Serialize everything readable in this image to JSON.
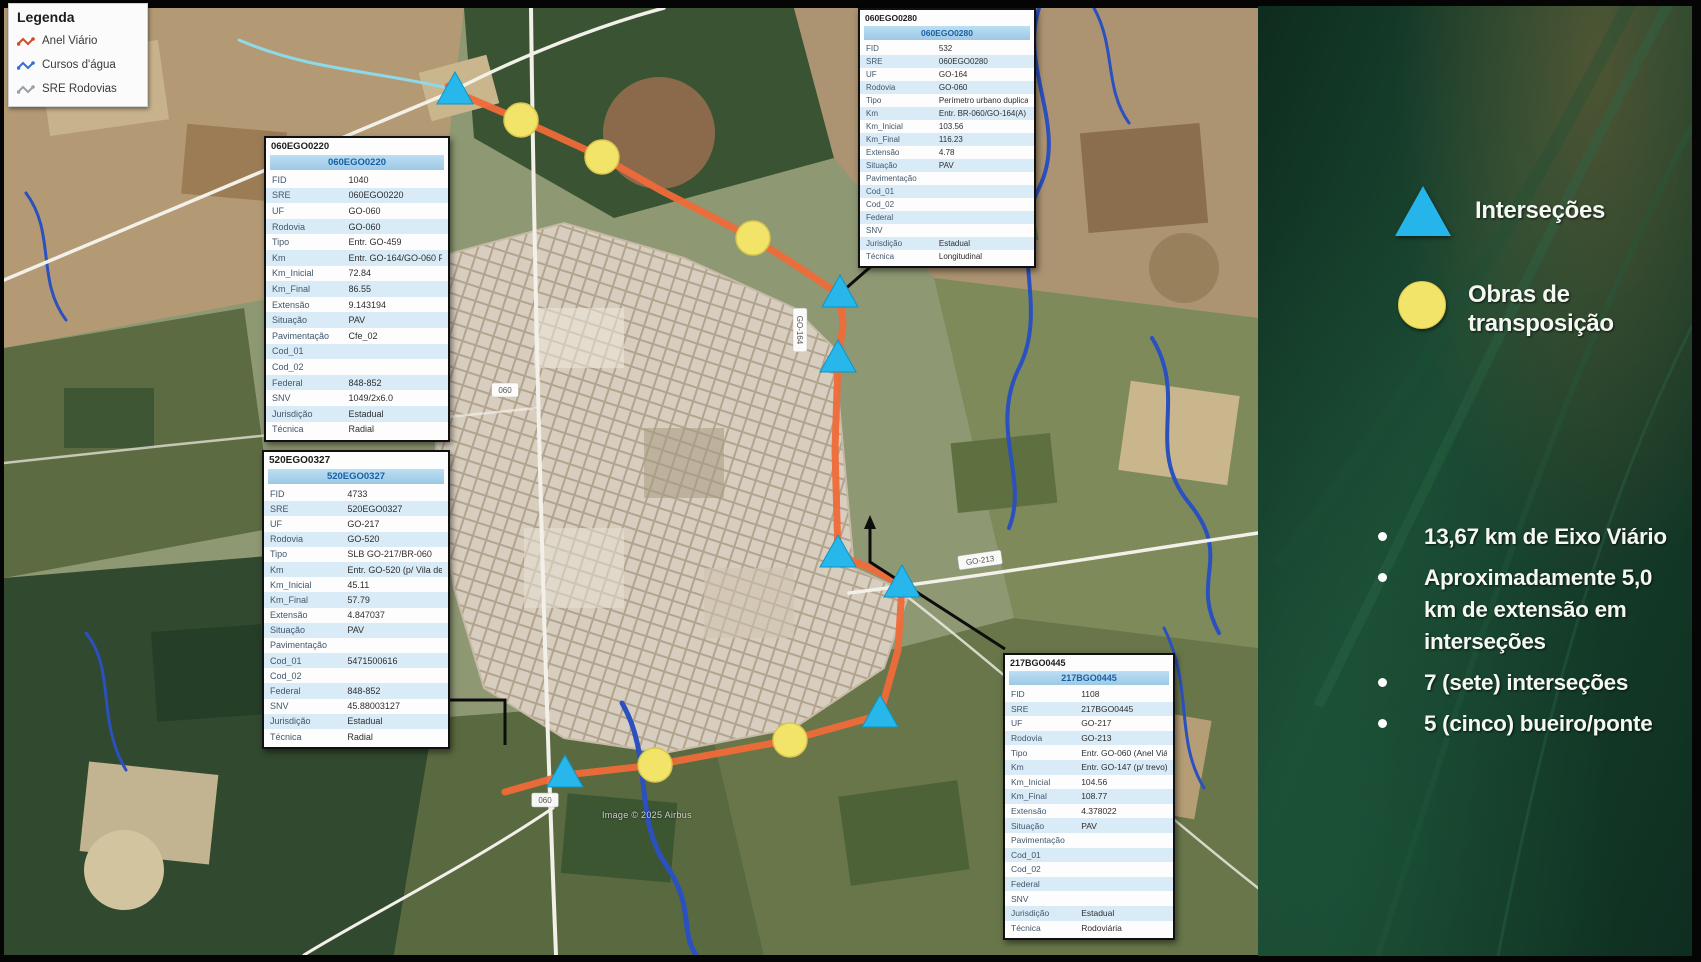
{
  "colors": {
    "route": "#f06a38",
    "intersection": "#27b7ea",
    "intersection_edge": "#0e94c6",
    "transposition": "#f2e468",
    "transposition_edge": "#d8c64e",
    "panel_header_bg": "#a9d2ec",
    "sidebar_green": "#1b4a33"
  },
  "legend_box": {
    "title": "Legenda",
    "items": [
      {
        "label": "Anel Viário",
        "color": "#d24a28",
        "icon": "route-line-icon"
      },
      {
        "label": "Cursos d'água",
        "color": "#3a6bd8",
        "icon": "water-line-icon"
      },
      {
        "label": "SRE Rodovias",
        "color": "#9aa0a8",
        "icon": "road-line-icon"
      }
    ]
  },
  "sidebar": {
    "legend_intersections": "Interseções",
    "legend_transpositions": "Obras de transposição",
    "bullets": [
      "13,67 km de Eixo Viário",
      "Aproximadamente 5,0 km de extensão em interseções",
      "7 (sete) interseções",
      "5 (cinco) bueiro/ponte"
    ]
  },
  "panels": [
    {
      "title": "060EGO0220",
      "header": "060EGO0220",
      "rows": [
        [
          "FID",
          "1040"
        ],
        [
          "SRE",
          "060EGO0220"
        ],
        [
          "UF",
          "GO-060"
        ],
        [
          "Rodovia",
          "GO-060"
        ],
        [
          "Tipo",
          "Entr. GO-459"
        ],
        [
          "Km",
          "Entr. GO-164/GO-060 Per. de Goiás"
        ],
        [
          "Km_Inicial",
          "72.84"
        ],
        [
          "Km_Final",
          "86.55"
        ],
        [
          "Extensão",
          "9.143194"
        ],
        [
          "Situação",
          "PAV"
        ],
        [
          "Pavimentação",
          "Cfe_02"
        ],
        [
          "Cod_01",
          ""
        ],
        [
          "Cod_02",
          ""
        ],
        [
          "Federal",
          "848-852"
        ],
        [
          "SNV",
          "1049/2x6.0"
        ],
        [
          "Jurisdição",
          "Estadual"
        ],
        [
          "Técnica",
          "Radial"
        ]
      ]
    },
    {
      "title": "520EGO0327",
      "header": "520EGO0327",
      "rows": [
        [
          "FID",
          "4733"
        ],
        [
          "SRE",
          "520EGO0327"
        ],
        [
          "UF",
          "GO-217"
        ],
        [
          "Rodovia",
          "GO-520"
        ],
        [
          "Tipo",
          "SLB GO-217/BR-060"
        ],
        [
          "Km",
          "Entr. GO-520 (p/ Vila de Goiás)"
        ],
        [
          "Km_Inicial",
          "45.11"
        ],
        [
          "Km_Final",
          "57.79"
        ],
        [
          "Extensão",
          "4.847037"
        ],
        [
          "Situação",
          "PAV"
        ],
        [
          "Pavimentação",
          ""
        ],
        [
          "Cod_01",
          "5471500616"
        ],
        [
          "Cod_02",
          ""
        ],
        [
          "Federal",
          "848-852"
        ],
        [
          "SNV",
          "45.88003127"
        ],
        [
          "Jurisdição",
          "Estadual"
        ],
        [
          "Técnica",
          "Radial"
        ]
      ]
    },
    {
      "title": "060EGO0280",
      "header": "060EGO0280",
      "rows": [
        [
          "FID",
          "532"
        ],
        [
          "SRE",
          "060EGO0280"
        ],
        [
          "UF",
          "GO-164"
        ],
        [
          "Rodovia",
          "GO-060"
        ],
        [
          "Tipo",
          "Perímetro urbano duplicado"
        ],
        [
          "Km",
          "Entr. BR-060/GO-164(A)"
        ],
        [
          "Km_Inicial",
          "103.56"
        ],
        [
          "Km_Final",
          "116.23"
        ],
        [
          "Extensão",
          "4.78"
        ],
        [
          "Situação",
          "PAV"
        ],
        [
          "Pavimentação",
          ""
        ],
        [
          "Cod_01",
          ""
        ],
        [
          "Cod_02",
          ""
        ],
        [
          "Federal",
          ""
        ],
        [
          "SNV",
          ""
        ],
        [
          "Jurisdição",
          "Estadual"
        ],
        [
          "Técnica",
          "Longitudinal"
        ]
      ]
    },
    {
      "title": "217BGO0445",
      "header": "217BGO0445",
      "rows": [
        [
          "FID",
          "1108"
        ],
        [
          "SRE",
          "217BGO0445"
        ],
        [
          "UF",
          "GO-217"
        ],
        [
          "Rodovia",
          "GO-213"
        ],
        [
          "Tipo",
          "Entr. GO-060 (Anel Viário)"
        ],
        [
          "Km",
          "Entr. GO-147 (p/ trevo)"
        ],
        [
          "Km_Inicial",
          "104.56"
        ],
        [
          "Km_Final",
          "108.77"
        ],
        [
          "Extensão",
          "4.378022"
        ],
        [
          "Situação",
          "PAV"
        ],
        [
          "Pavimentação",
          ""
        ],
        [
          "Cod_01",
          ""
        ],
        [
          "Cod_02",
          ""
        ],
        [
          "Federal",
          ""
        ],
        [
          "SNV",
          ""
        ],
        [
          "Jurisdição",
          "Estadual"
        ],
        [
          "Técnica",
          "Rodoviária"
        ]
      ]
    }
  ],
  "map": {
    "attribution": "Image © 2025 Airbus",
    "road_labels": [
      {
        "text": "060",
        "x": 501,
        "y": 382,
        "rot": 0
      },
      {
        "text": "060",
        "x": 541,
        "y": 792,
        "rot": 0
      },
      {
        "text": "GO-164",
        "x": 796,
        "y": 322,
        "rot": 90
      },
      {
        "text": "GO-213",
        "x": 976,
        "y": 552,
        "rot": -8
      }
    ],
    "route": [
      [
        444,
        78
      ],
      [
        451,
        84
      ],
      [
        517,
        112
      ],
      [
        598,
        149
      ],
      [
        656,
        182
      ],
      [
        749,
        230
      ],
      [
        796,
        260
      ],
      [
        836,
        287
      ],
      [
        839,
        317
      ],
      [
        834,
        352
      ],
      [
        831,
        442
      ],
      [
        834,
        547
      ],
      [
        866,
        560
      ],
      [
        898,
        577
      ],
      [
        894,
        642
      ],
      [
        876,
        707
      ],
      [
        786,
        732
      ],
      [
        651,
        757
      ],
      [
        561,
        767
      ],
      [
        501,
        784
      ]
    ],
    "intersections": [
      [
        451,
        84
      ],
      [
        836,
        287
      ],
      [
        834,
        352
      ],
      [
        834,
        547
      ],
      [
        898,
        577
      ],
      [
        876,
        707
      ],
      [
        561,
        767
      ]
    ],
    "transpositions": [
      [
        517,
        112
      ],
      [
        598,
        149
      ],
      [
        749,
        230
      ],
      [
        786,
        732
      ],
      [
        651,
        757
      ]
    ]
  }
}
